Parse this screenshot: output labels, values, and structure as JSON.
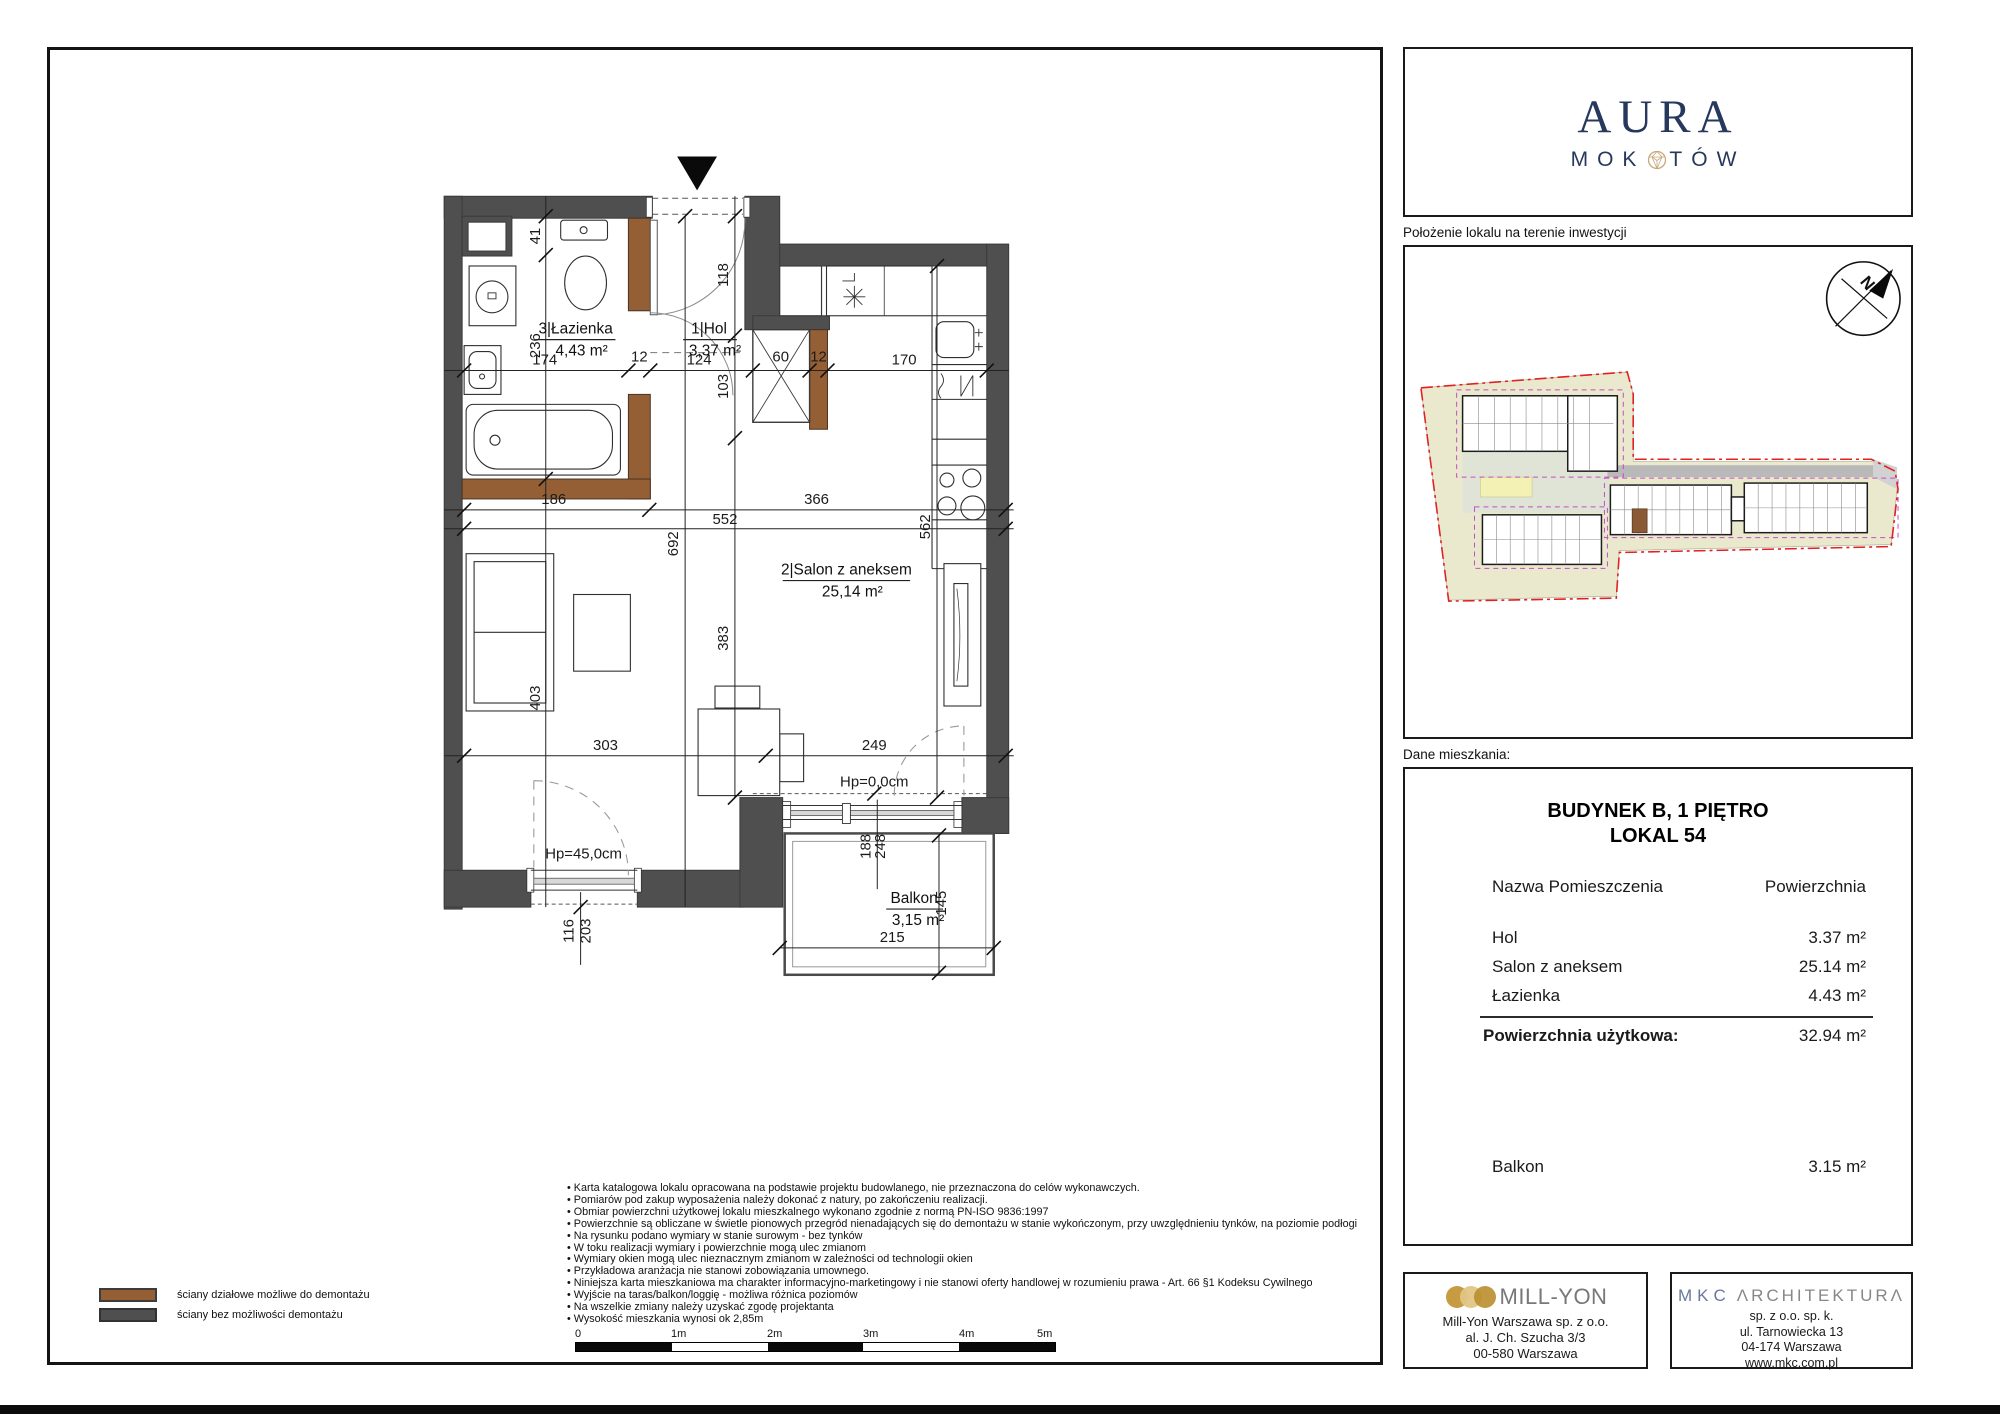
{
  "captions": {
    "site": "Położenie lokalu na terenie inwestycji",
    "data": "Dane mieszkania:"
  },
  "brand": {
    "name_top": "AURA",
    "name_bottom_left": "MOK",
    "name_bottom_right": "TÓW"
  },
  "compass": {
    "letter": "N"
  },
  "table": {
    "title_line1": "BUDYNEK B, 1 PIĘTRO",
    "title_line2": "LOKAL 54",
    "col_name": "Nazwa Pomieszczenia",
    "col_area": "Powierzchnia",
    "rows": [
      {
        "name": "Hol",
        "area": "3.37 m²"
      },
      {
        "name": "Salon z aneksem",
        "area": "25.14 m²"
      },
      {
        "name": "Łazienka",
        "area": "4.43 m²"
      }
    ],
    "total_label": "Powierzchnia użytkowa:",
    "total_value": "32.94 m²",
    "balcony": {
      "name": "Balkon",
      "area": "3.15 m²"
    }
  },
  "plan": {
    "rooms": {
      "bathroom": {
        "title": "3|Łazienka",
        "area": "4,43 m²"
      },
      "hall": {
        "title": "1|Hol",
        "area": "3,37 m²"
      },
      "living": {
        "title": "2|Salon z aneksem",
        "area": "25,14 m²"
      },
      "balcony": {
        "title": "Balkon",
        "area": "3,15 m²"
      }
    },
    "dims": {
      "d41": "41",
      "d236": "236",
      "d403": "403",
      "d174": "174",
      "d12a": "12",
      "d124": "124",
      "d60": "60",
      "d12b": "12",
      "d170": "170",
      "d118": "118",
      "d103": "103",
      "d383": "383",
      "d186": "186",
      "d366": "366",
      "d552": "552",
      "d692": "692",
      "d562": "562",
      "d303": "303",
      "d249": "249",
      "d248": "248",
      "d188": "188",
      "d145": "145",
      "d215": "215",
      "d203": "203",
      "d116": "116",
      "hp0": "Hp=0,0cm",
      "hp45": "Hp=45,0cm"
    }
  },
  "legend": {
    "items": [
      {
        "label": "ściany działowe możliwe do demontażu"
      },
      {
        "label": "ściany bez możliwości demontażu"
      }
    ]
  },
  "disclaimers": [
    "Karta katalogowa lokalu opracowana na podstawie projektu budowlanego, nie przeznaczona do celów wykonawczych.",
    "Pomiarów pod zakup wyposażenia należy dokonać z natury, po zakończeniu realizacji.",
    "Obmiar powierzchni użytkowej lokalu mieszkalnego wykonano zgodnie z normą PN-ISO 9836:1997",
    "Powierzchnie są obliczane w świetle pionowych przegród nienadających się do demontażu w stanie wykończonym, przy uwzględnieniu tynków, na poziomie podłogi",
    "Na rysunku podano wymiary w stanie surowym - bez tynków",
    "W toku realizacji wymiary i powierzchnie mogą ulec zmianom",
    "Wymiary okien mogą ulec nieznacznym zmianom w zależności od technologii okien",
    "Przykładowa aranżacja nie stanowi zobowiązania umownego.",
    "Niniejsza karta mieszkaniowa ma charakter informacyjno-marketingowy i nie stanowi oferty handlowej w rozumieniu prawa - Art. 66 §1 Kodeksu Cywilnego",
    "Wyjście na taras/balkon/loggię - możliwa różnica poziomów",
    "Na wszelkie zmiany należy uzyskać zgodę projektanta",
    "Wysokość mieszkania wynosi ok 2,85m"
  ],
  "scalebar": {
    "labels": [
      "0",
      "1m",
      "2m",
      "3m",
      "4m",
      "5m"
    ]
  },
  "footer": {
    "millyon": {
      "logo": "MILL-YON",
      "lines": [
        "Mill-Yon Warszawa sp. z o.o.",
        "al. J. Ch. Szucha 3/3",
        "00-580 Warszawa"
      ]
    },
    "mkc": {
      "logo_left": "MKC",
      "logo_right": "ΛRCHITEKTURΛ",
      "lines": [
        "sp. z o.o. sp. k.",
        "ul. Tarnowiecka 13",
        "04-174 Warszawa",
        "www.mkc.com.pl"
      ]
    }
  },
  "colors": {
    "wall_grey": "#4f4f4f",
    "wall_brown": "#955f35",
    "brand_navy": "#26395c",
    "gem_gold": "#c7a87c",
    "boundary_red": "#e02222",
    "boundary_magenta": "#c24fc2"
  }
}
